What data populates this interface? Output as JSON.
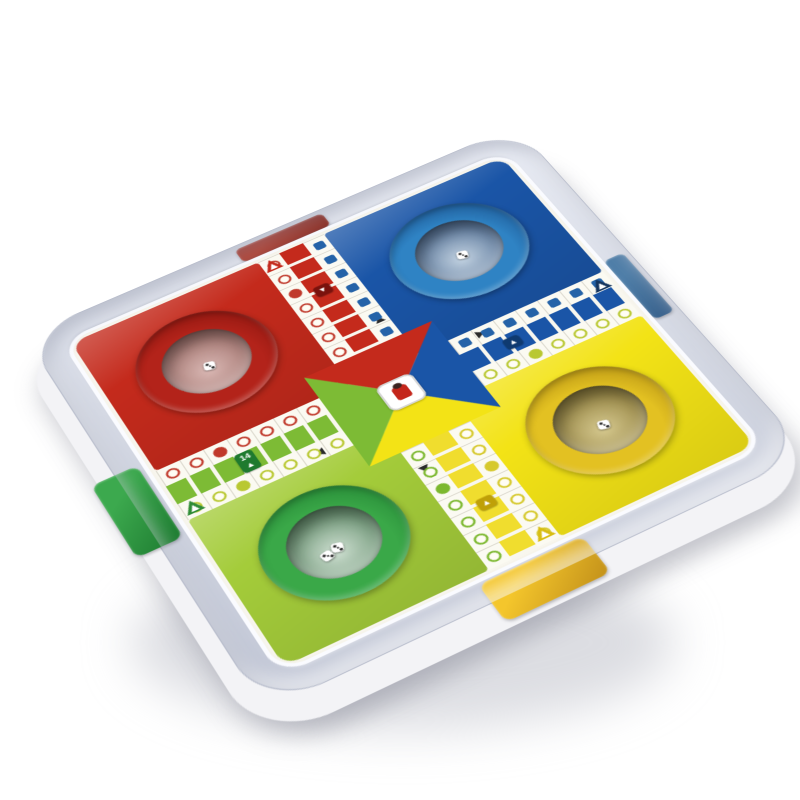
{
  "photo": {
    "description": "Parcheesi dice-popper board game in grey plastic tray, tilted product shot",
    "background": "#ffffff",
    "shadow_color": "rgba(186,188,198,0.5)"
  },
  "tray": {
    "top_light": "#e9ecf4",
    "top_color": "#d5d9e4",
    "edge_color": "#c2c7d6",
    "base_color": "#f3f3f6"
  },
  "tabs": [
    {
      "id": "red",
      "side": "top",
      "color": "#b04a3e",
      "color_dark": "#8c332a"
    },
    {
      "id": "blue",
      "side": "right",
      "color": "#507fa9",
      "color_dark": "#38608b"
    },
    {
      "id": "green",
      "side": "left",
      "color": "#3ca94e",
      "color_dark": "#1e7c31"
    },
    {
      "id": "yellow",
      "side": "bottom",
      "color": "#f4c62c",
      "color_dark": "#c3911a"
    }
  ],
  "board": {
    "bg": "#fdfcf5",
    "quadrants": [
      {
        "id": "red",
        "pos": "top-left",
        "color": "#c42a1c",
        "ring": "#b3231a",
        "ring_dark": "#7a110c",
        "dome_light": "#dab8b4",
        "dome_dark": "#8a5751",
        "dice": 1
      },
      {
        "id": "blue",
        "pos": "top-right",
        "color": "#1a55a7",
        "ring": "#2f83c4",
        "ring_dark": "#143f78",
        "dome_light": "#c3d3e2",
        "dome_dark": "#2b4d7a",
        "dice": 1
      },
      {
        "id": "green",
        "pos": "bottom-left",
        "color": "#a4cc3a",
        "ring": "#3aa848",
        "ring_dark": "#1d7a2e",
        "dome_light": "#cfe0d2",
        "dome_dark": "#3f7249",
        "dice": 2
      },
      {
        "id": "yellow",
        "pos": "bottom-right",
        "color": "#f3e316",
        "ring": "#e3c122",
        "ring_dark": "#a07c0e",
        "dome_light": "#d6c98f",
        "dome_dark": "#77641f",
        "dice": 1
      }
    ],
    "lanes": [
      {
        "id": "top",
        "ladder": "#c42a1c",
        "warn": "#c42a1c",
        "cells": 7,
        "dots_a": "#c0392b",
        "shape_a": "circle",
        "dots_b": "#2563a8",
        "shape_b": "square"
      },
      {
        "id": "right",
        "ladder": "#1a55a7",
        "warn": "#15355e",
        "cells": 7,
        "dots_a": "#2563a8",
        "shape_a": "square",
        "dots_b": "#b9c832",
        "shape_b": "circle"
      },
      {
        "id": "bottom",
        "ladder": "#f0dd2e",
        "warn": "#d8bd12",
        "cells": 7,
        "dots_a": "#7cb82f",
        "shape_a": "circle",
        "dots_b": "#d6c92e",
        "shape_b": "circle"
      },
      {
        "id": "left",
        "ladder": "#7dbb35",
        "warn": "#2e8b35",
        "cells": 7,
        "dots_a": "#c0392b",
        "shape_a": "circle",
        "dots_b": "#b9c832",
        "shape_b": "circle"
      }
    ],
    "badges": [
      {
        "lane": "top",
        "color": "#7a120d",
        "label": "▼"
      },
      {
        "lane": "right",
        "color": "#0f3a70",
        "label": "▲"
      },
      {
        "lane": "bottom",
        "color": "#bfa008",
        "label": "▲"
      },
      {
        "lane": "left",
        "color": "#1f7a2f",
        "label": "14",
        "sub": "▲"
      }
    ],
    "center": {
      "triangle_top": "#c42a1c",
      "triangle_right": "#1a55a7",
      "triangle_bottom": "#f3e316",
      "triangle_left": "#7dbb35",
      "logo_bg": "#ffffff",
      "logo_mark": "#c4261b"
    }
  },
  "dice": {
    "color": "#ffffff",
    "pip_color": "#2a2a2a"
  }
}
